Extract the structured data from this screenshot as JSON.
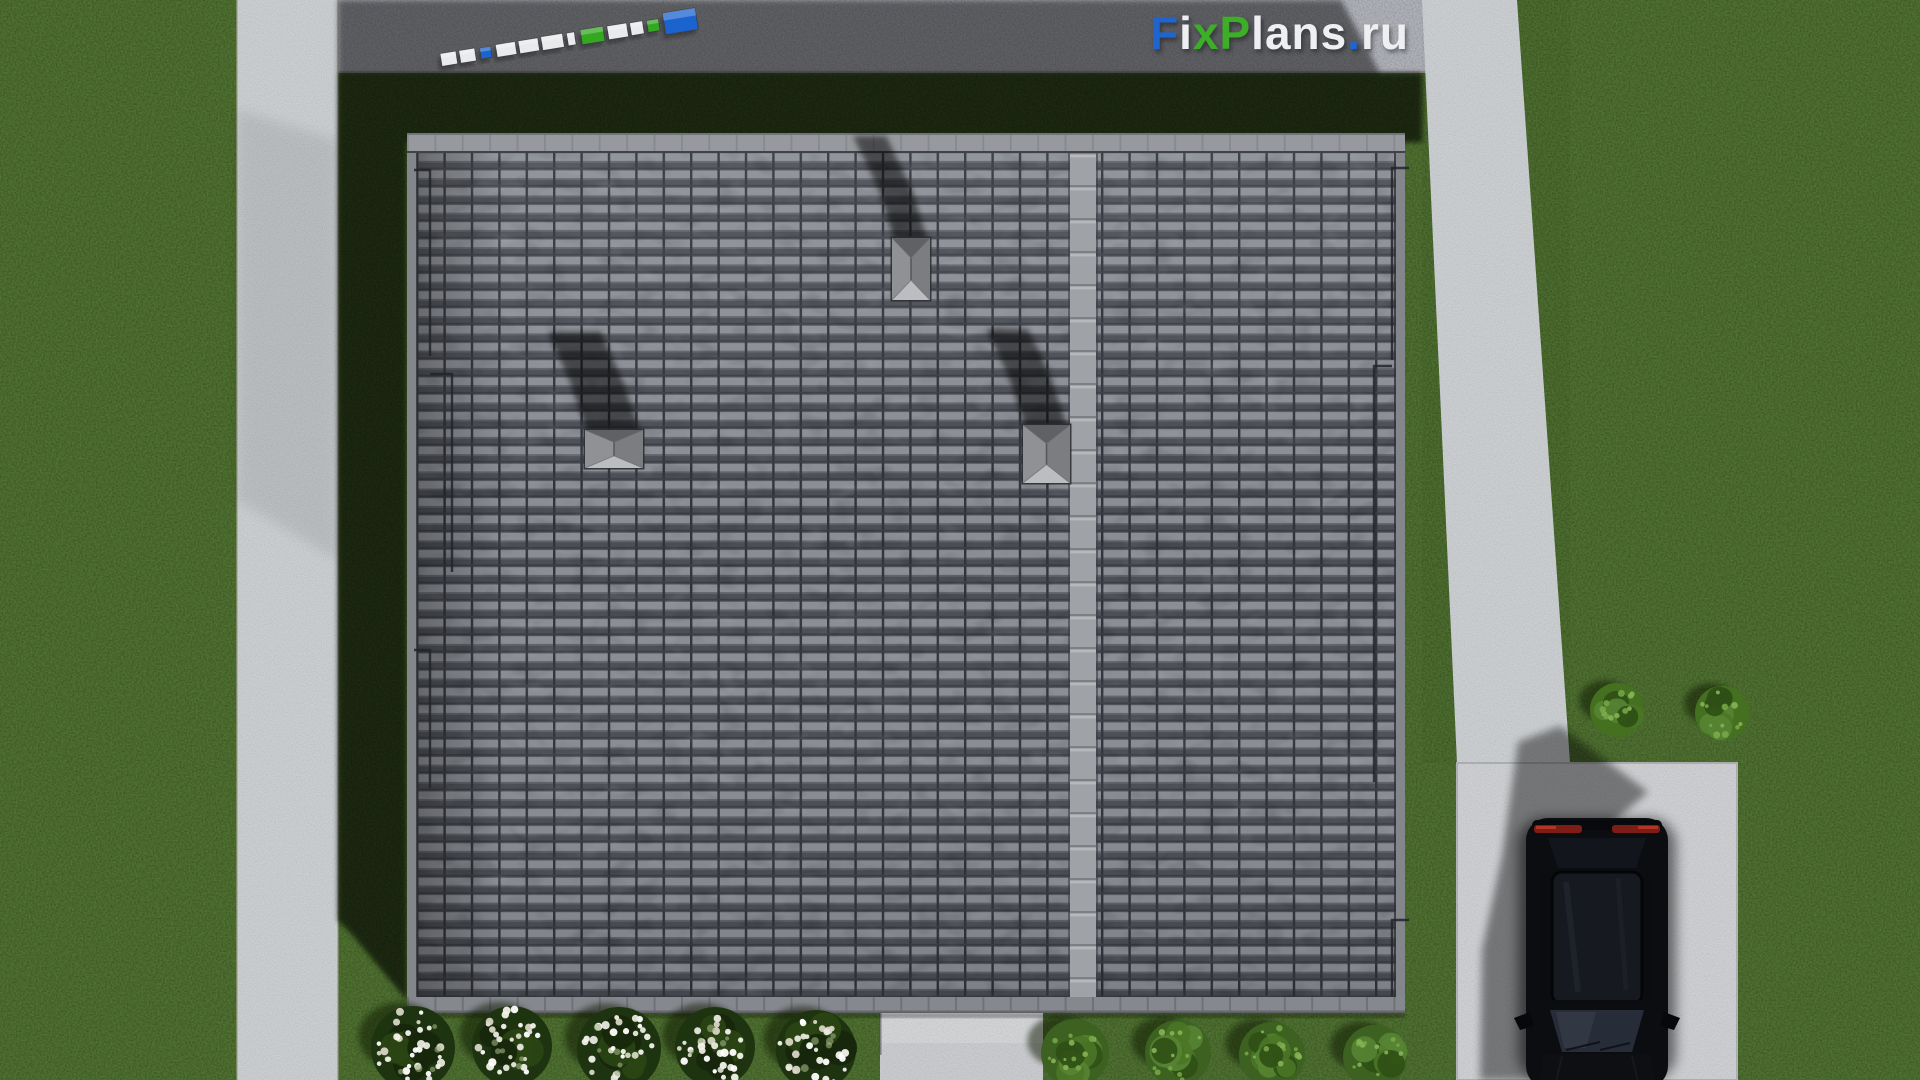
{
  "watermark": {
    "text": "FixPlans.ru",
    "segments": [
      {
        "text": "F",
        "cls": "c-blue"
      },
      {
        "text": "i",
        "cls": "c-white"
      },
      {
        "text": "x",
        "cls": "c-green"
      },
      {
        "text": "P",
        "cls": "c-green"
      },
      {
        "text": "lans",
        "cls": "c-white"
      },
      {
        "text": ".",
        "cls": "c-blue"
      },
      {
        "text": "ru",
        "cls": "c-white"
      }
    ]
  },
  "palette": {
    "grass": "#4e7030",
    "grass_shadow": "#1a2b12",
    "concrete": "#cdd0d3",
    "asphalt": "#b2b4b7",
    "roof_tile_dark": "#4b4e55",
    "roof_tile_light": "#8a8d94",
    "roof_ridge": "#9fa2a7",
    "roof_gutter": "#85888d",
    "logo_blue": "#1b63cf",
    "logo_green": "#35a822",
    "logo_white": "#e9eaec",
    "car_body": "#0b0d10",
    "taillight_red": "#7e1d15",
    "flower_white": "#f2f2ea"
  },
  "scene": {
    "view": "top-down roof plan render",
    "sun_direction": "bottom-right (shadows cast to upper-left)",
    "roof": {
      "tile_rows": 49,
      "tile_columns": 36,
      "ridge_x": 1070,
      "chimneys": [
        {
          "x": 892,
          "y": 238,
          "w": 38,
          "h": 62,
          "shadow": [
            [
              -16,
              -52
            ],
            [
              -42,
              -106
            ]
          ]
        },
        {
          "x": 585,
          "y": 430,
          "w": 58,
          "h": 38,
          "shadow": [
            [
              -18,
              -52
            ],
            [
              -40,
              -102
            ]
          ]
        },
        {
          "x": 1023,
          "y": 425,
          "w": 47,
          "h": 58,
          "shadow": [
            [
              -18,
              -54
            ],
            [
              -40,
              -100
            ]
          ]
        }
      ],
      "drain_lines": [
        {
          "x": 430,
          "y1": 170,
          "y2": 356,
          "hx": 414
        },
        {
          "x": 452,
          "y1": 374,
          "y2": 572,
          "hx": 430
        },
        {
          "x": 430,
          "y1": 650,
          "y2": 788,
          "hx": 414
        },
        {
          "x": 1392,
          "y1": 168,
          "y2": 360,
          "hx": 1409
        },
        {
          "x": 1374,
          "y1": 366,
          "y2": 782,
          "hx": 1392
        },
        {
          "x": 1392,
          "y1": 920,
          "y2": 996,
          "hx": 1409
        }
      ]
    },
    "logo3d": {
      "x": 441,
      "y": 60,
      "angle_deg": -9.2,
      "blocks": [
        {
          "o": 0,
          "w": 16,
          "h": 13,
          "c": "#e9eaec"
        },
        {
          "o": 19,
          "w": 16,
          "h": 13,
          "c": "#e9eaec"
        },
        {
          "o": 40,
          "w": 11,
          "h": 11,
          "c": "#1b63cf"
        },
        {
          "o": 56,
          "w": 20,
          "h": 13,
          "c": "#e9eaec"
        },
        {
          "o": 79,
          "w": 20,
          "h": 13,
          "c": "#e9eaec"
        },
        {
          "o": 102,
          "w": 22,
          "h": 14,
          "c": "#e9eaec"
        },
        {
          "o": 128,
          "w": 8,
          "h": 13,
          "c": "#e9eaec"
        },
        {
          "o": 142,
          "w": 23,
          "h": 15,
          "c": "#35a822"
        },
        {
          "o": 169,
          "w": 20,
          "h": 14,
          "c": "#e9eaec"
        },
        {
          "o": 192,
          "w": 13,
          "h": 13,
          "c": "#e9eaec"
        },
        {
          "o": 209,
          "w": 12,
          "h": 12,
          "c": "#35a822"
        },
        {
          "o": 226,
          "w": 33,
          "h": 22,
          "c": "#1b63cf"
        }
      ]
    },
    "vegetation": {
      "flower_bushes": [
        {
          "cx": 413,
          "cy": 1048,
          "r": 42
        },
        {
          "cx": 512,
          "cy": 1046,
          "r": 40
        },
        {
          "cx": 619,
          "cy": 1049,
          "r": 42
        },
        {
          "cx": 715,
          "cy": 1047,
          "r": 40
        },
        {
          "cx": 816,
          "cy": 1050,
          "r": 40
        }
      ],
      "green_bushes": [
        {
          "cx": 1075,
          "cy": 1053,
          "r": 34
        },
        {
          "cx": 1178,
          "cy": 1053,
          "r": 33
        },
        {
          "cx": 1272,
          "cy": 1055,
          "r": 33
        },
        {
          "cx": 1375,
          "cy": 1057,
          "r": 32
        }
      ],
      "side_bushes": [
        {
          "cx": 1617,
          "cy": 710,
          "r": 27
        },
        {
          "cx": 1722,
          "cy": 713,
          "r": 27
        }
      ]
    },
    "car": {
      "color": "black",
      "type": "suv",
      "position": "driveway bottom-right"
    }
  }
}
